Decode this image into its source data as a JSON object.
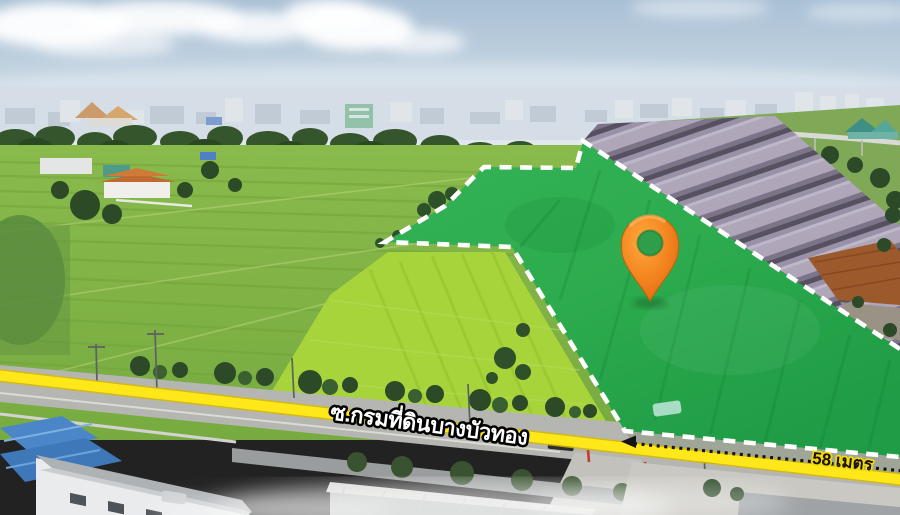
{
  "annotations": {
    "road_label": "ซ.กรมที่ดินบางบัวทอง",
    "distance_label": "58 เมตร",
    "marker_icon": "location-pin",
    "colors": {
      "plot_overlay_green": "#2dab4e",
      "boundary_dash": "#ffffff",
      "road_line_yellow": "#ffe81a",
      "road_line_edge": "#d8b900",
      "pin_orange": "#f1801d",
      "measure_line": "#151515"
    }
  }
}
